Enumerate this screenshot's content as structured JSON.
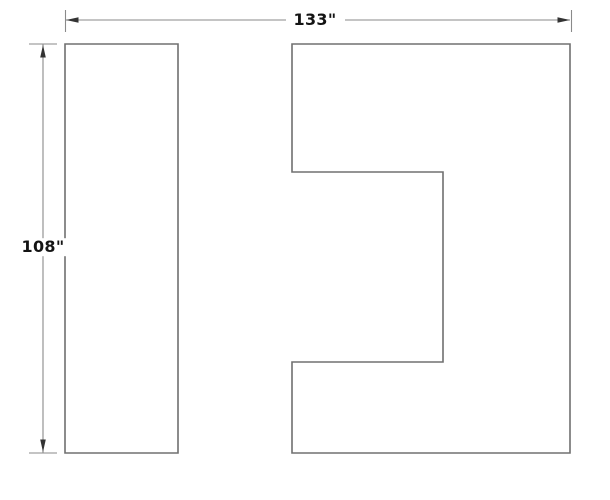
{
  "drawing": {
    "title": "floor-plan-panels-technical-drawing",
    "dimensions": {
      "horizontal": {
        "label": "133\""
      },
      "vertical": {
        "label": "108\""
      }
    },
    "colors": {
      "background": "#ffffff",
      "shape_stroke": "#707070",
      "dim_stroke": "#8a8a8a",
      "arrow_fill": "#333333",
      "label_text": "#141414"
    },
    "paths": {
      "left_rect": "M65,44 H178 V453 H65 Z",
      "right_polygon": "M292,44 H570 V453 H292 V362 H443 V172 H292 Z",
      "h_dim_line": "M66,20 H286 M345,20 H570",
      "h_dim_ext_left": "M65.5,10 V32",
      "h_dim_ext_right": "M571.5,10 V32",
      "h_arrow_left": "M66,20 L78.5,17.2 L78.5,22.8 Z",
      "h_arrow_right": "M570,20 L557.5,17.2 L557.5,22.8 Z",
      "v_dim_line": "M43,44 V453",
      "v_dim_ext_top": "M29,44 H57",
      "v_dim_ext_bottom": "M29,453 H57",
      "v_arrow_top": "M43,45 L40.2,57.5 L45.8,57.5 Z",
      "v_arrow_bottom": "M43,452 L40.2,439.5 L45.8,439.5 Z"
    }
  }
}
